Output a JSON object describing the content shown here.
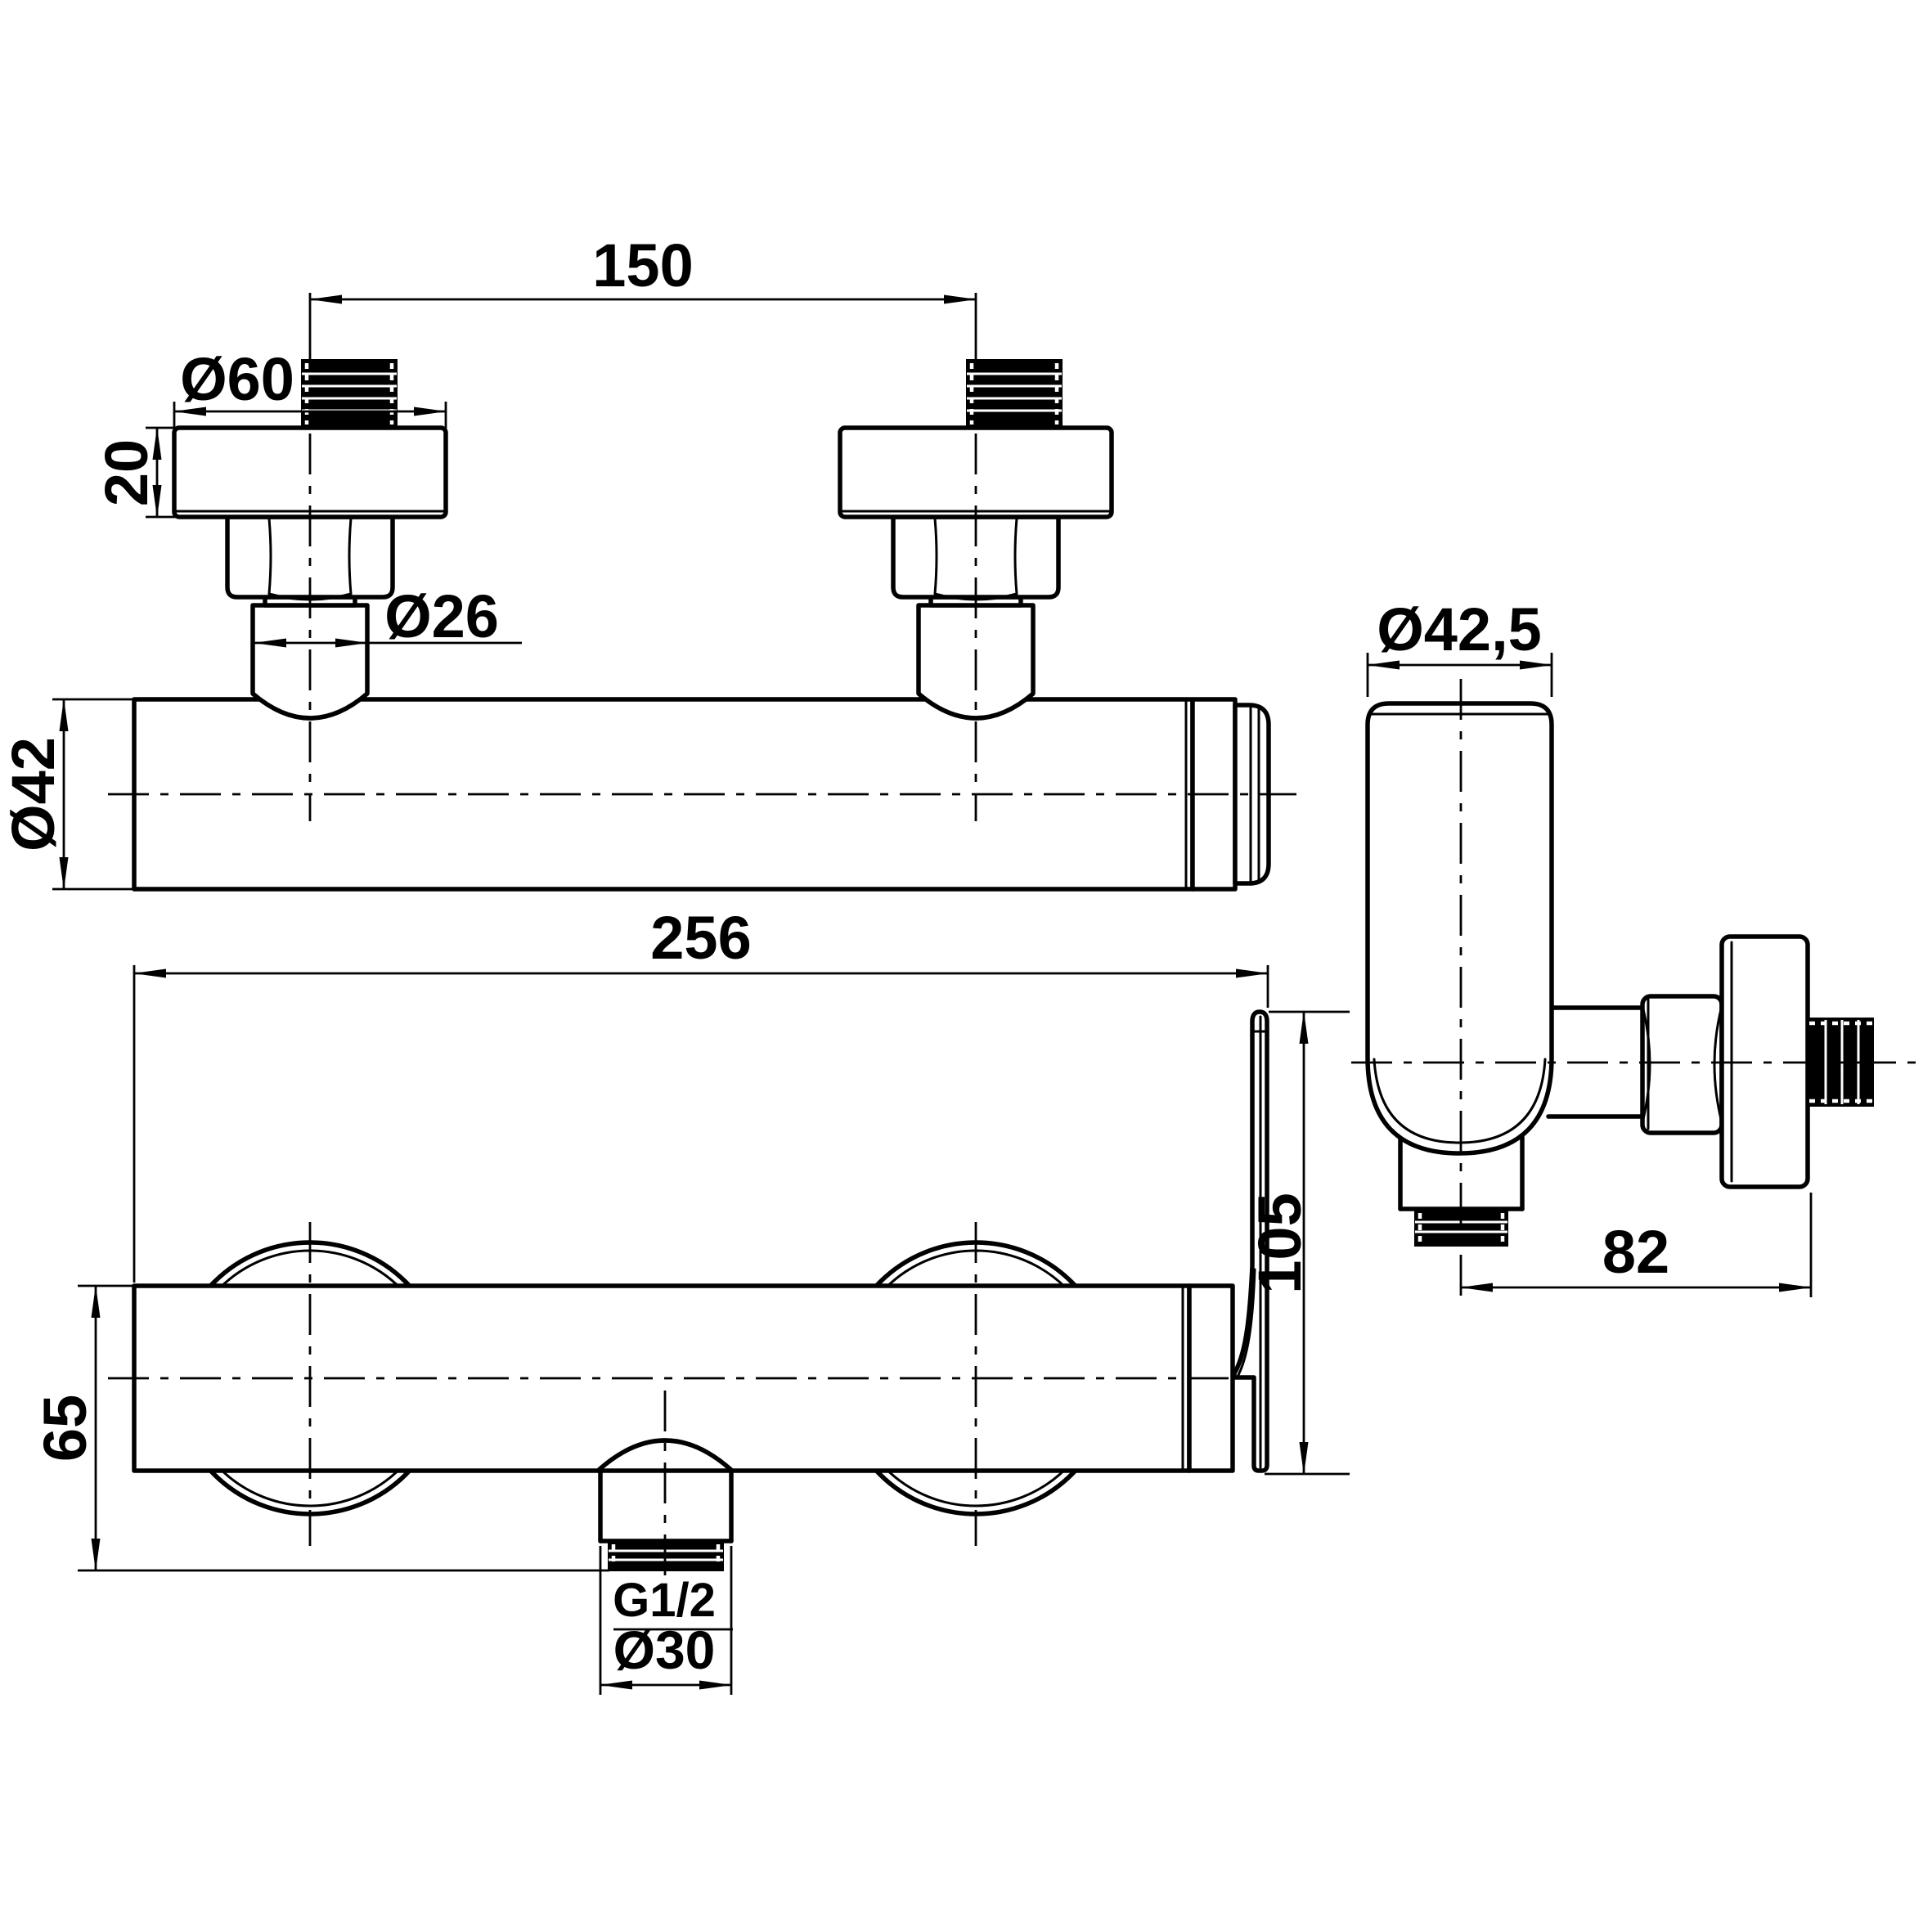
{
  "colors": {
    "ink": "#000000",
    "paper": "#ffffff"
  },
  "views": {
    "front": {
      "name": "front-view-shower-mixer-bar",
      "dims": {
        "union_spacing": "150",
        "escutcheon_diameter": "Ø60",
        "escutcheon_height": "20",
        "union_connector_diameter": "Ø26",
        "bar_diameter": "Ø42"
      }
    },
    "bottom": {
      "name": "bottom-view-shower-mixer-bar",
      "dims": {
        "overall_length": "256",
        "overall_depth": "65",
        "handle_length": "105",
        "outlet_thread": "G1/2",
        "outlet_collar_diameter": "Ø30"
      }
    },
    "side": {
      "name": "side-view-shower-mixer",
      "dims": {
        "handle_diameter": "Ø42,5",
        "wall_projection": "82"
      }
    }
  }
}
